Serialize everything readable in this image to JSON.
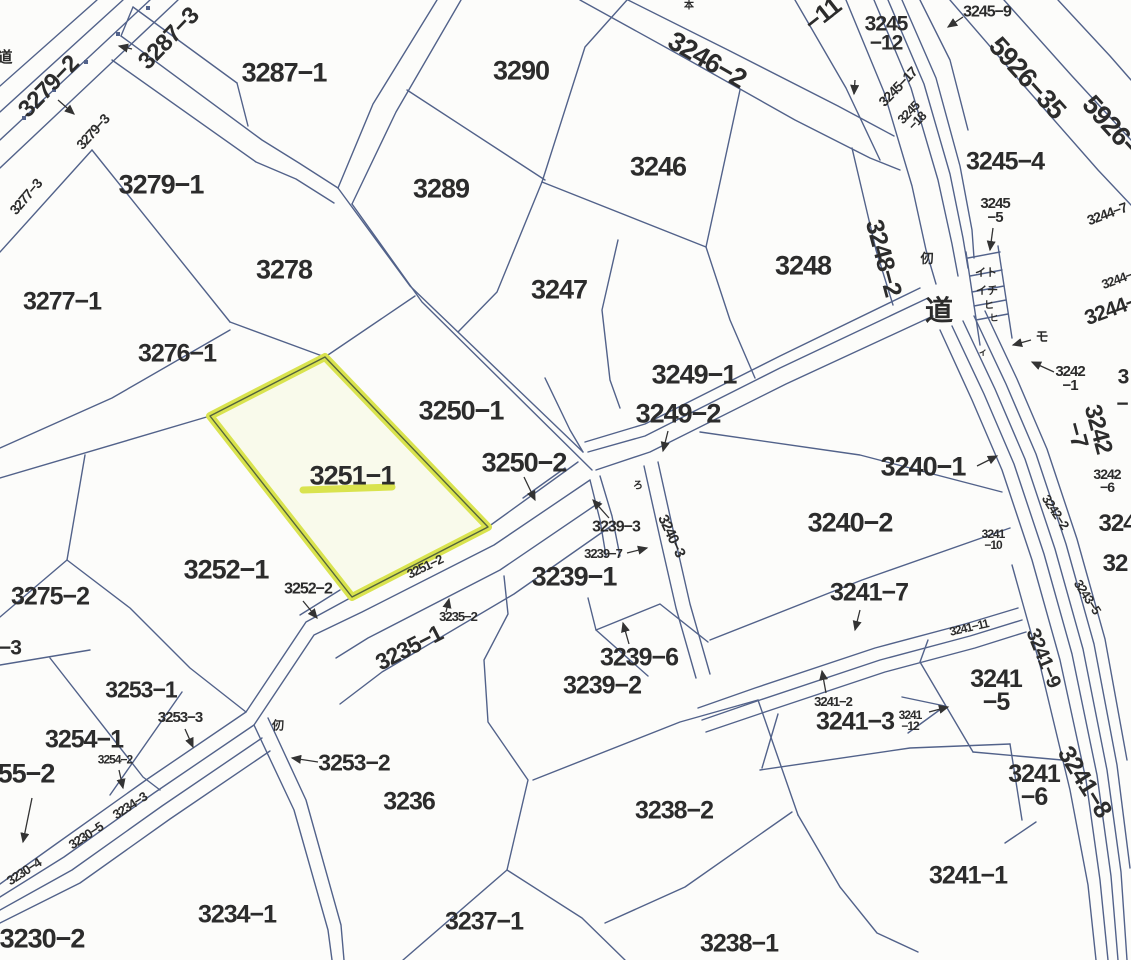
{
  "meta": {
    "type": "japanese-cadastral-parcel-map",
    "highlighted_parcel": "3251−1"
  },
  "colors": {
    "background": "#fcfcfa",
    "boundary_line": "#52628a",
    "text": "#2c2c2c",
    "arrow": "#333333",
    "highlight": "#d9e34e",
    "highlight_fill": "rgba(235,240,160,0.16)",
    "highlight_inner_line": "#55643c"
  },
  "highlight": {
    "parcel": "3251−1",
    "polygon": "325,357 210,416 352,597 488,527",
    "underline": [
      303,
      490,
      392,
      487
    ]
  },
  "labels": [
    {
      "t": "3287−1",
      "x": 284,
      "y": 73,
      "sz": 27
    },
    {
      "t": "3279−2",
      "x": 49,
      "y": 87,
      "sz": 24,
      "r": -46
    },
    {
      "t": "3279−3",
      "x": 93,
      "y": 132,
      "sz": 14,
      "r": -48
    },
    {
      "t": "3277−3",
      "x": 26,
      "y": 197,
      "sz": 14,
      "r": -50
    },
    {
      "t": "3287−3",
      "x": 169,
      "y": 39,
      "sz": 24,
      "r": -46
    },
    {
      "t": "3279−1",
      "x": 161,
      "y": 185,
      "sz": 27
    },
    {
      "t": "3277−1",
      "x": 62,
      "y": 302,
      "sz": 25
    },
    {
      "t": "3276−1",
      "x": 177,
      "y": 354,
      "sz": 25
    },
    {
      "t": "3278",
      "x": 284,
      "y": 270,
      "sz": 27
    },
    {
      "t": "3290",
      "x": 521,
      "y": 71,
      "sz": 27
    },
    {
      "t": "3289",
      "x": 441,
      "y": 189,
      "sz": 27
    },
    {
      "t": "3246−2",
      "x": 707,
      "y": 60,
      "sz": 27,
      "r": 30
    },
    {
      "t": "3246",
      "x": 658,
      "y": 167,
      "sz": 27
    },
    {
      "t": "3247",
      "x": 559,
      "y": 290,
      "sz": 27
    },
    {
      "t": "3248",
      "x": 803,
      "y": 266,
      "sz": 27
    },
    {
      "t": "−11",
      "x": 823,
      "y": 15,
      "sz": 25,
      "r": -38
    },
    {
      "t": "3245\n−12",
      "x": 886,
      "y": 34,
      "sz": 21
    },
    {
      "t": "3245−9",
      "x": 987,
      "y": 13,
      "sz": 16
    },
    {
      "t": "3245−17",
      "x": 898,
      "y": 87,
      "sz": 14,
      "r": -46
    },
    {
      "t": "3245\n−18",
      "x": 913,
      "y": 117,
      "sz": 13,
      "r": -46
    },
    {
      "t": "5926−35",
      "x": 1027,
      "y": 78,
      "sz": 27,
      "r": 48
    },
    {
      "t": "5926−",
      "x": 1111,
      "y": 126,
      "sz": 27,
      "r": 48
    },
    {
      "t": "3245−4",
      "x": 1005,
      "y": 162,
      "sz": 25
    },
    {
      "t": "3245\n−5",
      "x": 995,
      "y": 211,
      "sz": 15
    },
    {
      "t": "3244−7",
      "x": 1107,
      "y": 214,
      "sz": 14,
      "r": -20
    },
    {
      "t": "3244−",
      "x": 1117,
      "y": 280,
      "sz": 13,
      "r": -20
    },
    {
      "t": "3244−",
      "x": 1111,
      "y": 310,
      "sz": 21,
      "r": -20
    },
    {
      "t": "3248−2",
      "x": 883,
      "y": 258,
      "sz": 25,
      "r": 75
    },
    {
      "t": "仞",
      "x": 927,
      "y": 259,
      "sz": 13,
      "cjk": true
    },
    {
      "t": "道",
      "x": 939,
      "y": 311,
      "sz": 28,
      "cjk": true
    },
    {
      "t": "イト",
      "x": 986,
      "y": 273,
      "sz": 11,
      "cjk": true
    },
    {
      "t": "イチ",
      "x": 987,
      "y": 291,
      "sz": 11,
      "cjk": true
    },
    {
      "t": "ヒ",
      "x": 989,
      "y": 306,
      "sz": 10,
      "cjk": true
    },
    {
      "t": "ヒ",
      "x": 994,
      "y": 318,
      "sz": 9,
      "cjk": true
    },
    {
      "t": "ィ",
      "x": 983,
      "y": 352,
      "sz": 9,
      "cjk": true
    },
    {
      "t": "モ",
      "x": 1042,
      "y": 337,
      "sz": 13,
      "cjk": true
    },
    {
      "t": "3242\n−1",
      "x": 1070,
      "y": 379,
      "sz": 15
    },
    {
      "t": "3242\n −7",
      "x": 1087,
      "y": 432,
      "sz": 24,
      "r": 75
    },
    {
      "t": "3242\n−6",
      "x": 1107,
      "y": 481,
      "sz": 14
    },
    {
      "t": "3242−2",
      "x": 1055,
      "y": 512,
      "sz": 13,
      "r": 57
    },
    {
      "t": "3243−5",
      "x": 1087,
      "y": 597,
      "sz": 13,
      "r": 57
    },
    {
      "t": "324",
      "x": 1117,
      "y": 524,
      "sz": 24
    },
    {
      "t": "32",
      "x": 1115,
      "y": 564,
      "sz": 24
    },
    {
      "t": "3",
      "x": 1123,
      "y": 377,
      "sz": 21
    },
    {
      "t": "−",
      "x": 1122,
      "y": 404,
      "sz": 21
    },
    {
      "t": "3249−1",
      "x": 694,
      "y": 375,
      "sz": 27
    },
    {
      "t": "3249−2",
      "x": 678,
      "y": 414,
      "sz": 27
    },
    {
      "t": "3250−1",
      "x": 461,
      "y": 411,
      "sz": 27
    },
    {
      "t": "3250−2",
      "x": 524,
      "y": 463,
      "sz": 27
    },
    {
      "t": "3251−1",
      "x": 352,
      "y": 476,
      "sz": 27
    },
    {
      "t": "3240−1",
      "x": 923,
      "y": 467,
      "sz": 27
    },
    {
      "t": "3240−2",
      "x": 850,
      "y": 523,
      "sz": 27
    },
    {
      "t": "3240−3",
      "x": 671,
      "y": 536,
      "sz": 15,
      "r": 65
    },
    {
      "t": "3239−3",
      "x": 616,
      "y": 528,
      "sz": 16
    },
    {
      "t": "3239−7",
      "x": 603,
      "y": 554,
      "sz": 13
    },
    {
      "t": "3239−1",
      "x": 574,
      "y": 577,
      "sz": 27
    },
    {
      "t": "3239−6",
      "x": 639,
      "y": 658,
      "sz": 25
    },
    {
      "t": "3239−2",
      "x": 602,
      "y": 686,
      "sz": 25
    },
    {
      "t": "3252−1",
      "x": 226,
      "y": 570,
      "sz": 27
    },
    {
      "t": "3252−2",
      "x": 308,
      "y": 590,
      "sz": 16
    },
    {
      "t": "3251−2",
      "x": 425,
      "y": 567,
      "sz": 13,
      "r": -26
    },
    {
      "t": "3235−2",
      "x": 458,
      "y": 617,
      "sz": 13
    },
    {
      "t": "3235−1",
      "x": 409,
      "y": 648,
      "sz": 23,
      "r": -27
    },
    {
      "t": "3253−2",
      "x": 354,
      "y": 763,
      "sz": 23
    },
    {
      "t": "3236",
      "x": 409,
      "y": 802,
      "sz": 25
    },
    {
      "t": "3253−1",
      "x": 141,
      "y": 690,
      "sz": 23
    },
    {
      "t": "3253−3",
      "x": 180,
      "y": 718,
      "sz": 15
    },
    {
      "t": "3254−1",
      "x": 84,
      "y": 740,
      "sz": 25
    },
    {
      "t": "3254−2",
      "x": 115,
      "y": 760,
      "sz": 12
    },
    {
      "t": "55−2",
      "x": 26,
      "y": 774,
      "sz": 27
    },
    {
      "t": "3275−2",
      "x": 50,
      "y": 597,
      "sz": 25
    },
    {
      "t": "−3",
      "x": 10,
      "y": 648,
      "sz": 21
    },
    {
      "t": "3230−5",
      "x": 86,
      "y": 836,
      "sz": 13,
      "r": -33
    },
    {
      "t": "3234−3",
      "x": 130,
      "y": 806,
      "sz": 13,
      "r": -33
    },
    {
      "t": "3230−4",
      "x": 24,
      "y": 872,
      "sz": 13,
      "r": -33
    },
    {
      "t": "3230−2",
      "x": 42,
      "y": 939,
      "sz": 27
    },
    {
      "t": "3234−1",
      "x": 237,
      "y": 915,
      "sz": 25
    },
    {
      "t": "3237−1",
      "x": 484,
      "y": 922,
      "sz": 25
    },
    {
      "t": "3238−2",
      "x": 674,
      "y": 811,
      "sz": 25
    },
    {
      "t": "3238−1",
      "x": 739,
      "y": 944,
      "sz": 25
    },
    {
      "t": "3241−7",
      "x": 869,
      "y": 593,
      "sz": 25
    },
    {
      "t": "3241\n−10",
      "x": 993,
      "y": 540,
      "sz": 12
    },
    {
      "t": "3241−11",
      "x": 969,
      "y": 628,
      "sz": 12,
      "r": -13
    },
    {
      "t": "3241−9",
      "x": 1043,
      "y": 658,
      "sz": 20,
      "r": 68
    },
    {
      "t": "3241−2",
      "x": 833,
      "y": 702,
      "sz": 13
    },
    {
      "t": "3241−3",
      "x": 855,
      "y": 722,
      "sz": 25
    },
    {
      "t": "3241\n−12",
      "x": 910,
      "y": 721,
      "sz": 12
    },
    {
      "t": "3241\n−5",
      "x": 996,
      "y": 691,
      "sz": 25
    },
    {
      "t": "3241\n−6",
      "x": 1034,
      "y": 786,
      "sz": 25
    },
    {
      "t": "3241−8",
      "x": 1084,
      "y": 782,
      "sz": 25,
      "r": 58
    },
    {
      "t": "3241−1",
      "x": 968,
      "y": 876,
      "sz": 25
    },
    {
      "t": "仞",
      "x": 278,
      "y": 726,
      "sz": 12,
      "cjk": true
    },
    {
      "t": "ろ",
      "x": 638,
      "y": 486,
      "sz": 10,
      "cjk": true
    },
    {
      "t": "本",
      "x": 689,
      "y": 6,
      "sz": 10,
      "cjk": true
    },
    {
      "t": "道",
      "x": 5,
      "y": 58,
      "sz": 15,
      "cjk": true
    }
  ],
  "arrows": [
    [
      58,
      100,
      74,
      114
    ],
    [
      132,
      49,
      119,
      46
    ],
    [
      963,
      17,
      948,
      27
    ],
    [
      993,
      228,
      990,
      250
    ],
    [
      855,
      80,
      854,
      94
    ],
    [
      1031,
      340,
      1013,
      345
    ],
    [
      1054,
      372,
      1032,
      362
    ],
    [
      668,
      431,
      663,
      451
    ],
    [
      524,
      477,
      535,
      500
    ],
    [
      977,
      466,
      997,
      456
    ],
    [
      609,
      518,
      593,
      500
    ],
    [
      627,
      553,
      647,
      548
    ],
    [
      629,
      644,
      623,
      623
    ],
    [
      303,
      601,
      317,
      618
    ],
    [
      446,
      612,
      449,
      599
    ],
    [
      318,
      762,
      292,
      758
    ],
    [
      185,
      729,
      193,
      747
    ],
    [
      119,
      770,
      123,
      788
    ],
    [
      32,
      798,
      23,
      842
    ],
    [
      860,
      610,
      855,
      630
    ],
    [
      826,
      693,
      822,
      671
    ],
    [
      929,
      712,
      948,
      707
    ]
  ],
  "linework": [
    "M0,86 L97,0",
    "M0,112 L123,0",
    "M0,140 L150,0",
    "M0,168 L178,0",
    "M121,36 L262,140 L299,163 L338,188",
    "M112,60 L256,162 L296,179 L334,203",
    "M133,7 L237,83",
    "M133,7 L121,36",
    "M237,83 L248,126",
    "M437,0 L373,104 L338,188",
    "M461,0 L396,112 L352,204",
    "M338,188 L410,286 L583,452",
    "M352,204 L422,302 L592,470",
    "M407,90 L545,180",
    "M627,0 L585,47 L542,182",
    "M542,182 L497,292 L458,332",
    "M542,182 L706,247",
    "M740,90 L706,247 L730,320 L755,378",
    "M852,148 L876,250 L893,305",
    "M928,298 L780,368 L645,436 L588,452",
    "M933,316 L786,384 L650,452 L596,470",
    "M920,288 L780,356 L645,424 L585,442",
    "M618,240 L602,310 L610,380 L620,408",
    "M545,378 L570,430 L583,452",
    "M565,468 L523,498",
    "M325,357 L415,296",
    "M325,357 L230,322",
    "M92,150 L230,322",
    "M230,330 L112,398 L0,448",
    "M0,252 L92,150",
    "M0,478 L210,416",
    "M85,455 L67,560",
    "M0,617 L67,560",
    "M67,560 L130,608 L190,668 L246,712",
    "M0,665 L90,650",
    "M50,658 L143,777 L160,790",
    "M182,692 L110,795",
    "M578,462 L488,527 L352,597 L306,622 L246,712 L146,780 L56,844 L0,884",
    "M590,480 L494,545 L362,612 L314,635 L254,725 L154,793 L64,857 L0,897",
    "M262,738 L162,806 L72,870 L0,910",
    "M270,751 L170,819 L80,883 L0,923",
    "M340,590 L300,615",
    "M254,725 L294,810 L328,930 L332,960",
    "M268,718 L306,800 L341,925 L344,960",
    "M600,502 L500,570 L368,638 L336,658",
    "M614,524 L514,594 L382,672 L340,704",
    "M504,576 L508,614 L484,660 L488,722 L528,780 L507,870",
    "M403,960 L507,870",
    "M507,870 L582,918 L625,960",
    "M590,480 L600,520 L606,556",
    "M600,476 L612,516 L620,556",
    "M588,598 L596,630 L660,604 L708,642",
    "M596,630 L648,676",
    "M533,780 L680,722 L758,700",
    "M758,700 L798,815",
    "M605,923 L685,887 L792,812",
    "M644,466 L660,538 L676,608 L696,678",
    "M658,462 L674,534 L690,604 L710,674",
    "M700,432 L860,455 L1002,492",
    "M710,640 L862,580 L1010,528",
    "M698,708 L755,688 L875,648 L965,624 L1018,608",
    "M702,720 L760,700 L880,660 L970,636 L1022,620",
    "M706,732 L765,712 L885,672 L975,648 L1026,632",
    "M928,640 L920,662 L973,752",
    "M973,752 L1062,760",
    "M778,714 L762,768",
    "M902,697 L945,706 L908,733",
    "M760,770 L910,748 L1010,744",
    "M1010,744 L1022,820",
    "M798,815 L840,887 L877,933 L918,952",
    "M1005,843 L1036,822",
    "M940,330 L972,400 L1002,470 L1032,560 L1060,660 L1086,780 L1100,880 L1108,960",
    "M952,326 L984,394 L1014,464 L1044,554 L1072,654 L1097,775 L1111,876 L1118,960",
    "M963,321 L995,389 L1025,459 L1055,549 L1083,649 L1107,770 L1121,872 L1127,960",
    "M974,316 L1006,384 L1036,454 L1066,544 L1094,644 L1117,765 L1130,868",
    "M985,311 L1017,379 L1047,449 L1077,539 L1105,639 L1127,760",
    "M1012,565 L1040,665 L1070,790 L1088,885 L1096,960",
    "M846,0 L884,92 L912,186 L926,250 L936,284",
    "M874,0 L911,88 L938,180 L952,244 L958,276",
    "M888,0 L924,84 L950,174 L963,238 L968,268",
    "M902,0 L936,78 L960,166 L972,230 L974,258",
    "M920,0 L950,60 L968,130",
    "M795,0 L846,88 L880,160",
    "M950,0 L1026,88 L1098,170 L1131,205",
    "M1004,0 L1072,76 L1131,140",
    "M1058,0 L1110,56 L1131,80",
    "M628,0 L728,50 L838,106 L894,136",
    "M580,0 L685,58 L795,120 L870,158 L900,170",
    "M966,252 L980,345",
    "M998,246 L1012,338",
    "M968,258 L1000,252",
    "M970,276 L1002,270",
    "M972,292 L1004,286",
    "M974,306 L1006,300",
    "M976,320 L1008,314"
  ],
  "dots": [
    [
      24,
      118
    ],
    [
      54,
      90
    ],
    [
      86,
      62
    ],
    [
      118,
      34
    ],
    [
      148,
      8
    ]
  ]
}
